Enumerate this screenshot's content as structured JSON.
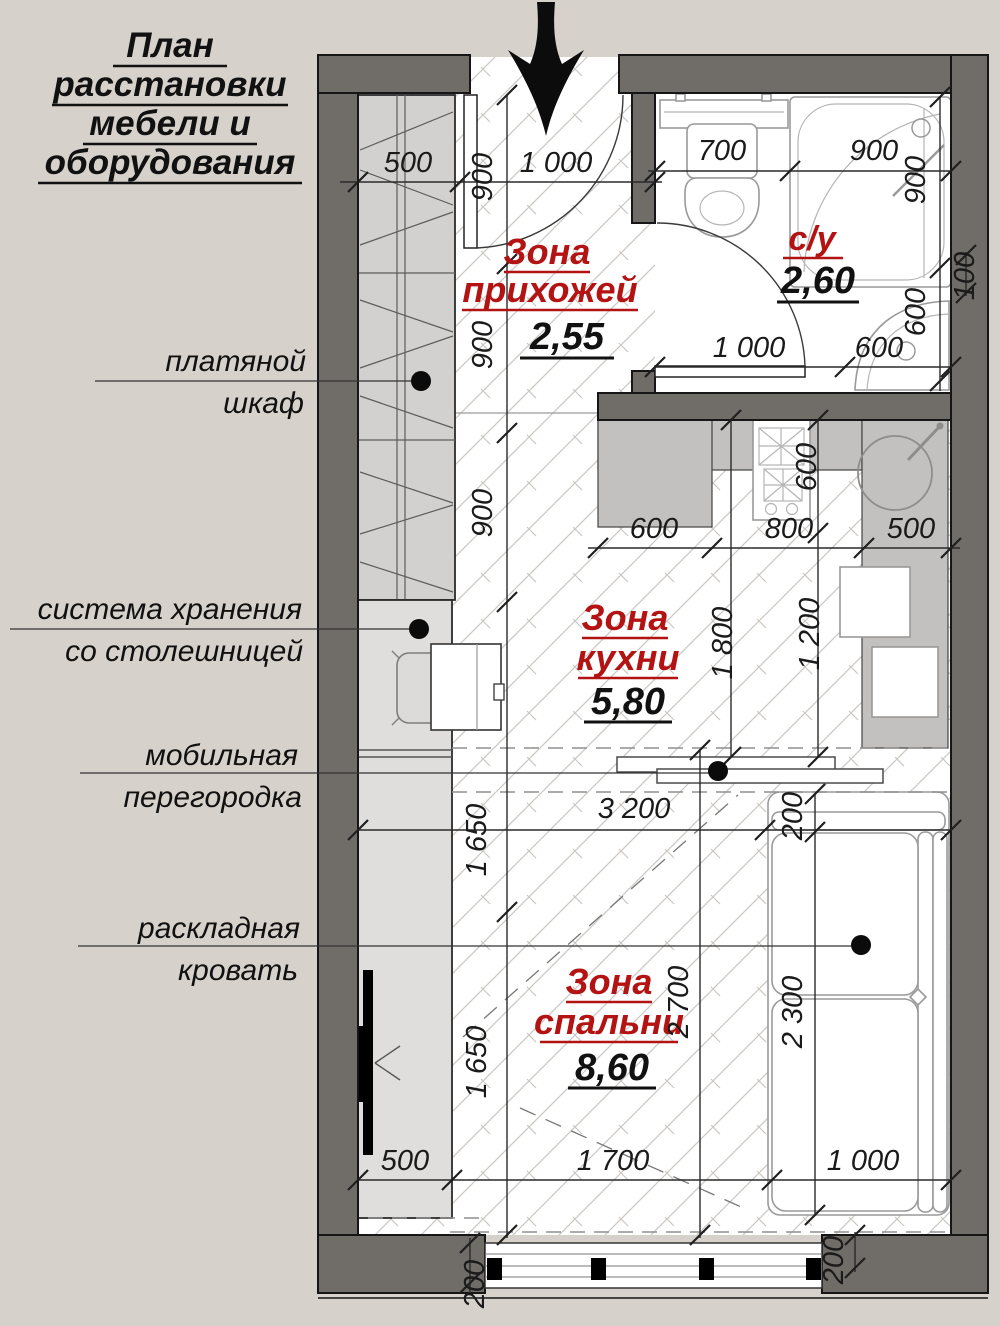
{
  "title": {
    "line1": "План",
    "line2": "расстановки",
    "line3": "мебели и",
    "line4": "оборудования"
  },
  "annotations": {
    "wardrobe_line1": "платяной",
    "wardrobe_line2": "шкаф",
    "storage_line1": "система хранения",
    "storage_line2": "со столешницей",
    "partition_line1": "мобильная",
    "partition_line2": "перегородка",
    "bed_line1": "раскладная",
    "bed_line2": "кровать"
  },
  "zones": {
    "hallway": {
      "name_line1": "Зона",
      "name_line2": "прихожей",
      "area": "2,55"
    },
    "bathroom": {
      "name": "с/у",
      "area": "2,60"
    },
    "kitchen": {
      "name_line1": "Зона",
      "name_line2": "кухни",
      "area": "5,80"
    },
    "bedroom": {
      "name_line1": "Зона",
      "name_line2": "спальни",
      "area": "8,60"
    }
  },
  "dims": {
    "hall_500": "500",
    "hall_1000": "1 000",
    "hall_900_1": "900",
    "hall_900_2": "900",
    "hall_900_3": "900",
    "bath_700": "700",
    "bath_900_top": "900",
    "bath_900_right": "900",
    "bath_100_right": "100",
    "bath_600_right": "600",
    "bath_1000_bottom": "1 000",
    "bath_600_bottom": "600",
    "kitchen_600_top": "600",
    "kitchen_600_left": "600",
    "kitchen_800": "800",
    "kitchen_500": "500",
    "kitchen_1800": "1 800",
    "kitchen_1200": "1 200",
    "bedroom_3200": "3 200",
    "bedroom_200": "200",
    "bedroom_2300": "2 300",
    "bedroom_2700": "2 700",
    "bedroom_1650_1": "1 650",
    "bedroom_1650_2": "1 650",
    "bottom_500": "500",
    "bottom_1700": "1 700",
    "bottom_1000": "1 000",
    "bottom_200_left": "200",
    "bottom_200_right": "200"
  },
  "colors": {
    "zone_label": "#b31312",
    "wall": "#706c68",
    "background": "#d7d1cb"
  }
}
